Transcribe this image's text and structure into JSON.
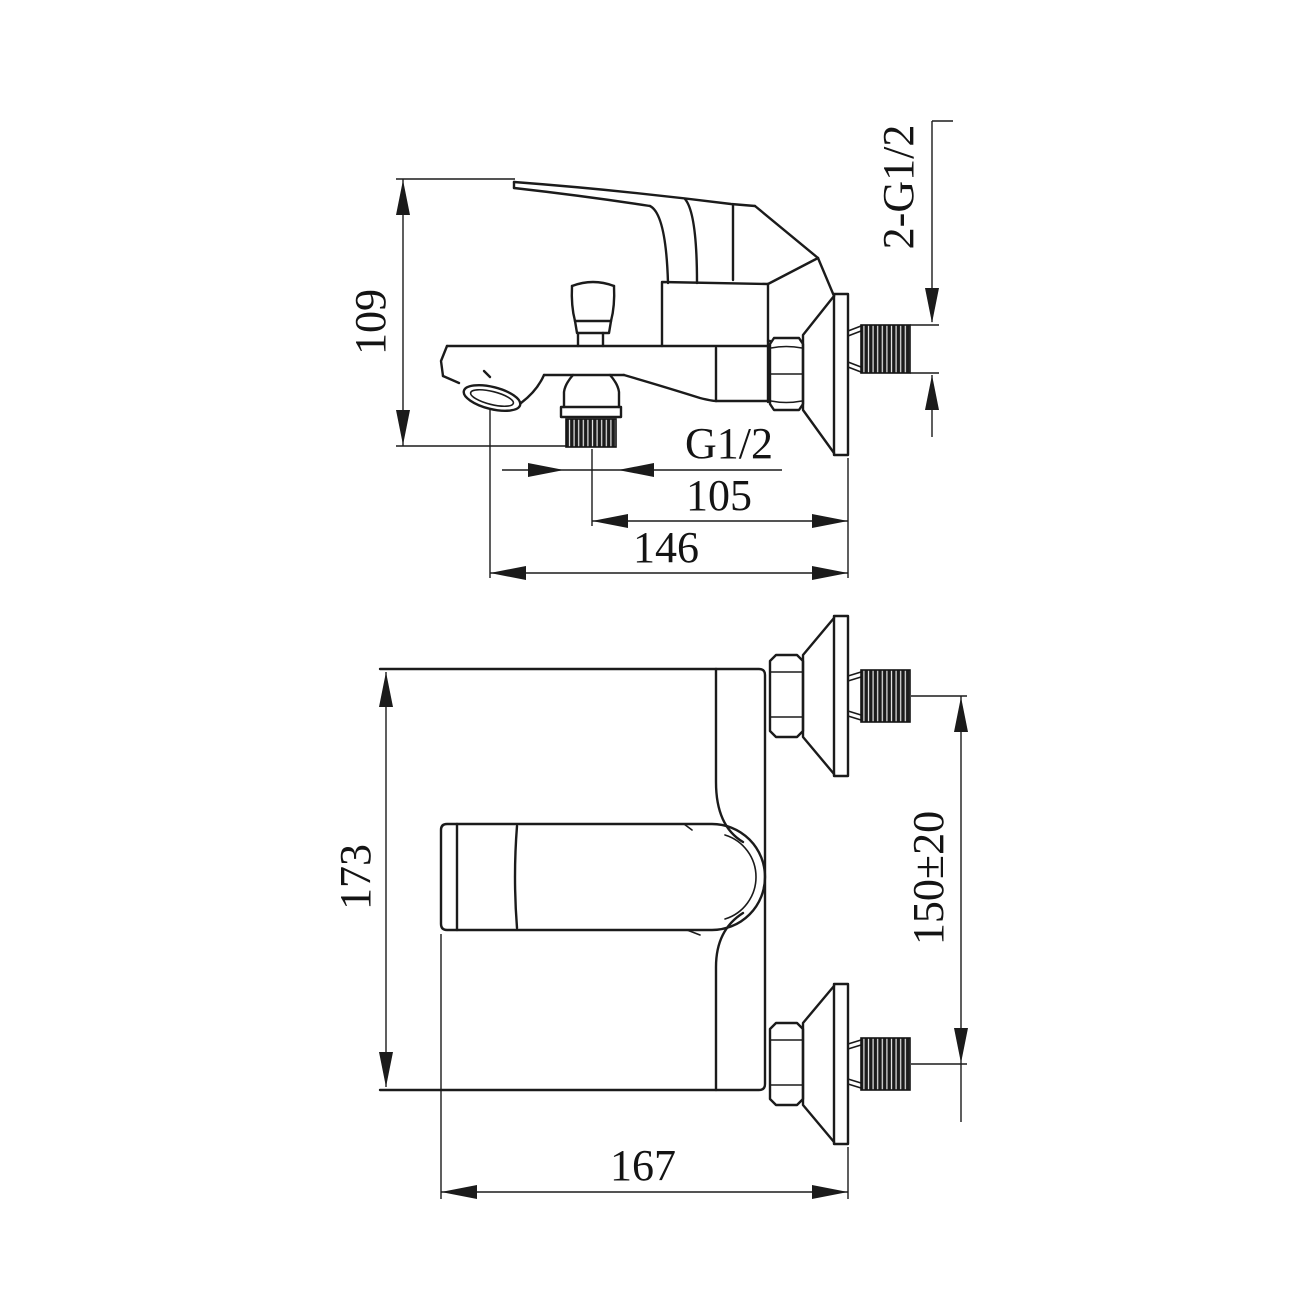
{
  "colors": {
    "line": "#1b1b1b",
    "background": "#ffffff"
  },
  "side_view": {
    "dims": {
      "height": "109",
      "wall_thread": "2-G1/2",
      "outlet_thread": "G1/2",
      "outlet_offset": "105",
      "reach": "146"
    }
  },
  "front_view": {
    "dims": {
      "overall_height": "173",
      "inlet_spacing": "150±20",
      "overall_width": "167"
    }
  }
}
